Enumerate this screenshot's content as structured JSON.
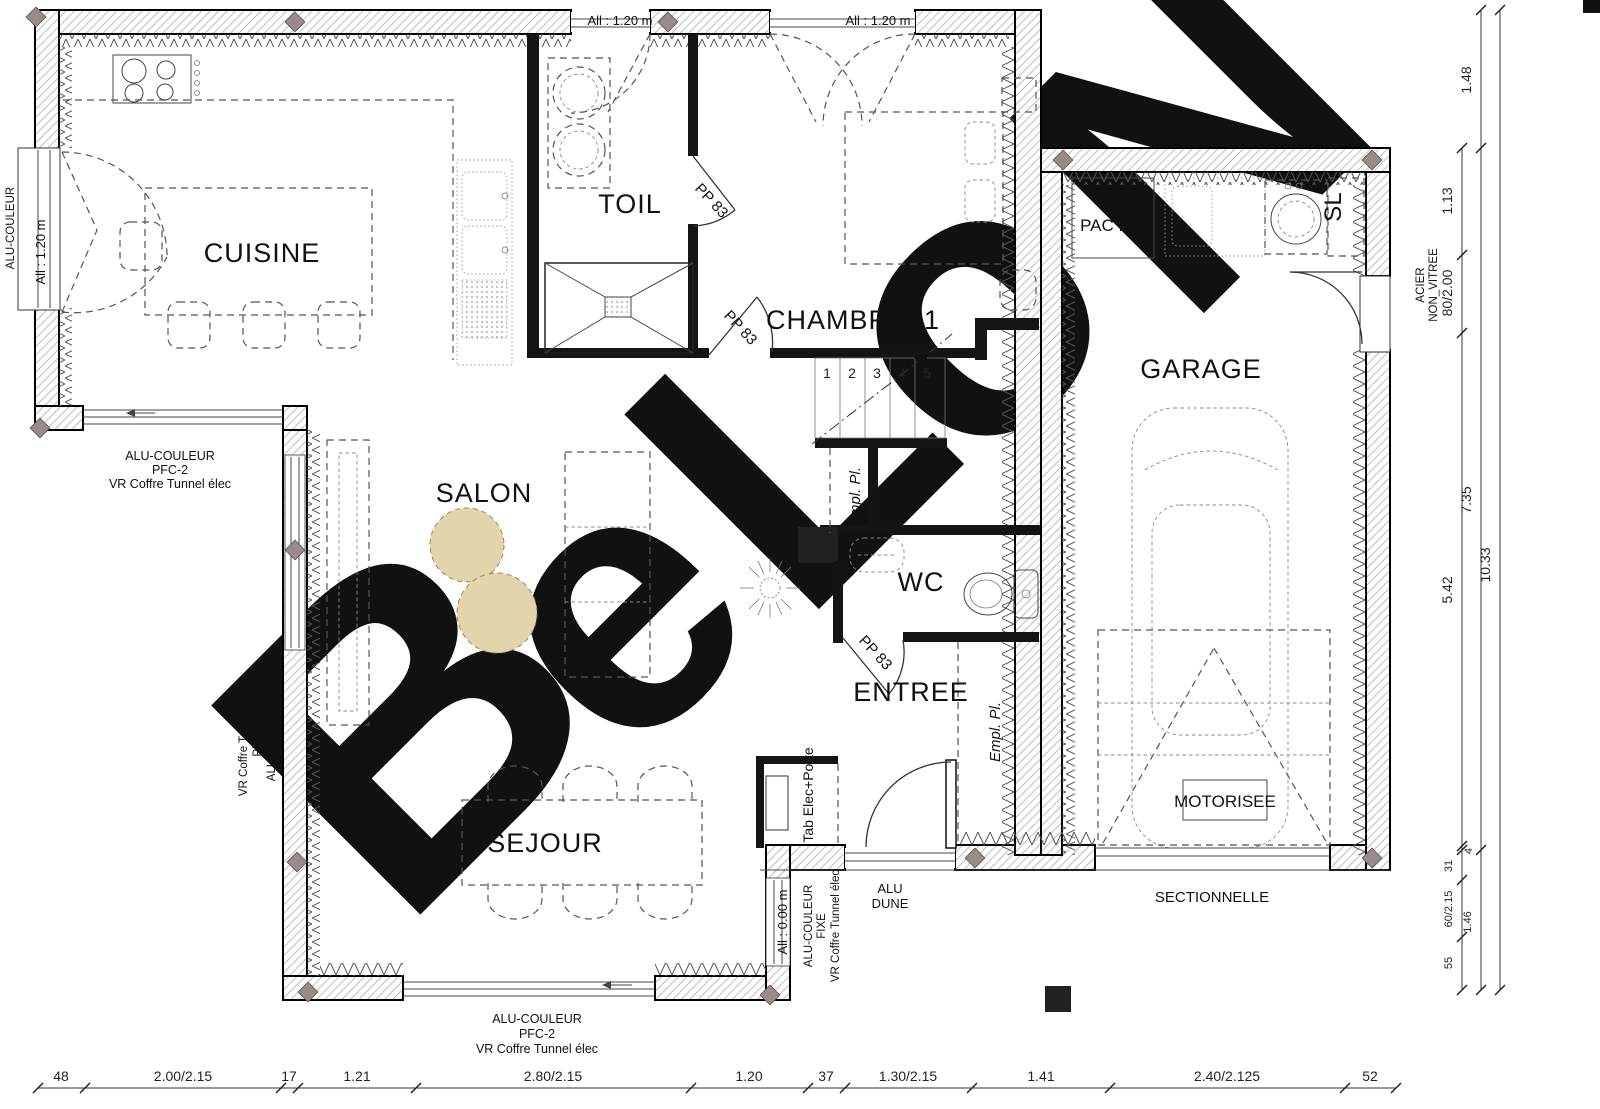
{
  "labels": {
    "rooms": {
      "cuisine": "CUISINE",
      "toil": "TOIL",
      "chambre": "CHAMBRE_1",
      "salon": "SALON",
      "sejour": "SEJOUR",
      "entree": "ENTREE",
      "wc": "WC",
      "garage": "GARAGE"
    },
    "equipment": {
      "pac": "PAC INT",
      "sl": "SL",
      "motorisee": "MOTORISEE",
      "sectionnelle": "SECTIONNELLE",
      "alu": "ALU",
      "dune": "DUNE",
      "tab_elec": "Tab Elec+Porte",
      "empl_pl": "Empl. Pl."
    },
    "doors": {
      "pp83": "PP 83",
      "acier": "ACIER",
      "non_vitree": "NON_VITREE"
    },
    "windows": {
      "all_120": "All : 1.20 m",
      "all_000": "All : 0.00 m",
      "alu_couleur": "ALU-COULEUR",
      "fixe": "FIXE",
      "pfc2": "PFC-2",
      "vr_coffre": "VR Coffre Tunnel élec"
    }
  },
  "stairs": [
    "1",
    "2",
    "3",
    "4",
    "5"
  ],
  "dims_bottom": [
    "48",
    "2.00/2.15",
    "17",
    "1.21",
    "2.80/2.15",
    "1.20",
    "37",
    "1.30/2.15",
    "1.41",
    "2.40/2.125",
    "52"
  ],
  "dims_right": [
    "1.48",
    "1.13",
    "80/2.00",
    "5.42",
    "4",
    "31",
    "60/2.15",
    "55",
    "7.35",
    "1.46",
    "10.33"
  ],
  "watermark": {
    "letters": [
      "B",
      "e",
      "L",
      "o",
      "N"
    ],
    "gray": "#d9d9d9",
    "yellow": "#f8e49e"
  },
  "colors": {
    "pouf": "#e3d4ab",
    "diamond": "#9b8a8a",
    "wall_hatch": "#a8a8a8"
  }
}
